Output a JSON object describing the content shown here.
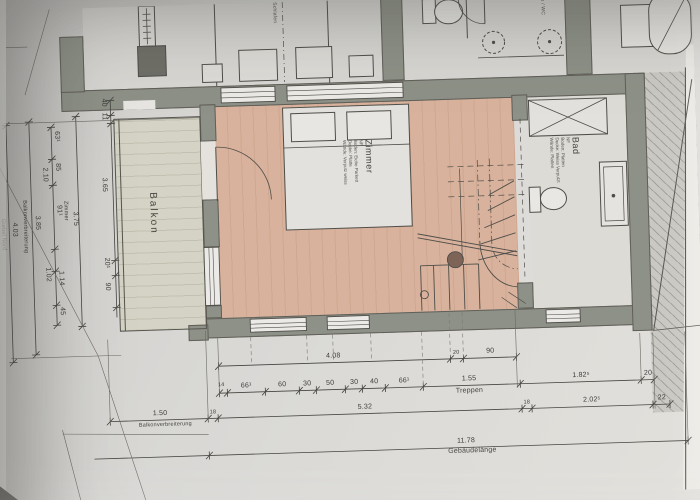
{
  "plan": {
    "rooms": {
      "balkon": {
        "label": "Balkon"
      },
      "zimmer": {
        "label": "Zimmer",
        "finishes": [
          "NF",
          "Boden: Eiche Parkett",
          "Decke: Platte",
          "Wände: Verputz weiss"
        ]
      },
      "bad": {
        "label": "Bad",
        "finishes": [
          "NF",
          "Boden: Platten",
          "Decke: Weiss Verputzt",
          "Wände: Platten"
        ]
      },
      "schlafen": {
        "label": "Schlafen"
      },
      "du_wc": {
        "label": "Du / WC"
      },
      "treppen": {
        "label": "Treppen"
      }
    },
    "dimensions": {
      "left_inner": [
        "40",
        "11",
        "3.65",
        "20¹",
        "90"
      ],
      "left_zimmer": {
        "label": "Zimmer",
        "value": "3.75"
      },
      "left_segments": [
        "63¹",
        "85",
        "2.10",
        "91¹",
        "1.02",
        "1.14",
        "45"
      ],
      "left_balkonverbreiterung": {
        "label": "Balkonverbreiterung",
        "value": "3.85"
      },
      "left_giebel": {
        "label": "Giebel Nord",
        "value": "4.03"
      },
      "row_top": [
        "4.08",
        "20",
        "90"
      ],
      "row_detail": [
        "14",
        "66¹",
        "60",
        "30",
        "50",
        "30",
        "40",
        "66¹",
        "1.55",
        "1.82⁵",
        "20"
      ],
      "row_mid": [
        "1.50",
        "18",
        "5.32",
        "18",
        "2.02⁵",
        "22"
      ],
      "row_mid_label": "Balkonverbreiterung",
      "row_total": {
        "value": "11.78",
        "label": "Gebäudelänge"
      }
    },
    "colors": {
      "parquet": "#d8b29c",
      "wall": "#8d9187",
      "paper": "#d8d7d4",
      "newel": "#7d6457"
    }
  }
}
